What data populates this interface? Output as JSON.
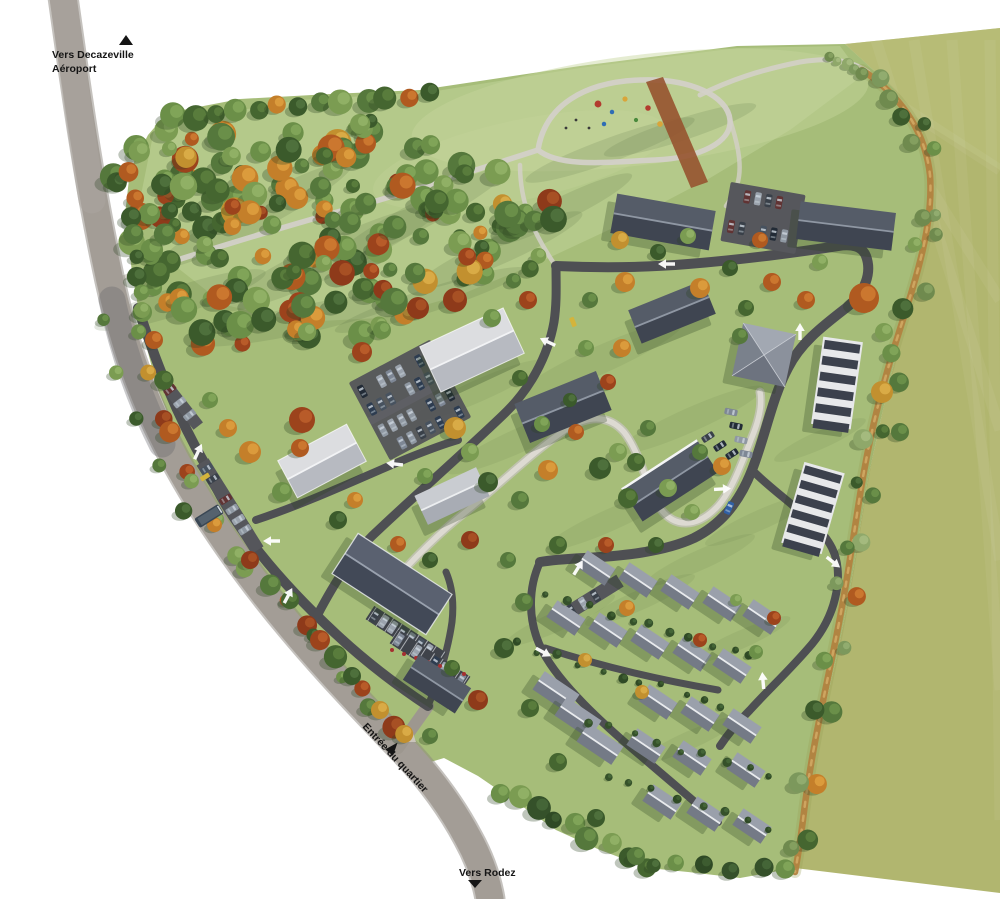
{
  "map": {
    "labels": {
      "north": {
        "line1": "Vers Decazeville",
        "line2": "Aéroport",
        "marker": "triangle-up-icon"
      },
      "south": {
        "text": "Vers Rodez",
        "marker": "triangle-down-icon"
      },
      "entrance": {
        "text": "Entrée du quartier",
        "marker": "triangle-right-icon"
      }
    },
    "icons": [
      "triangle-up-icon",
      "triangle-down-icon",
      "triangle-right-icon",
      "road-direction-arrow-icon"
    ],
    "colors": {
      "background": "#ffffff",
      "field": "#b1b66f",
      "field_light": "#bcc17c",
      "grass": "#a6bd79",
      "park": "#b6ca8c",
      "mow_light": "#c6d59c",
      "road_main": "#a39d96",
      "road_casing": "#8b857d",
      "road_inner": "#4e4f53",
      "path": "#d3d0c8",
      "walkway": "#dddad2",
      "dirt_path": "#b2823f",
      "red_path": "#96532f",
      "roof_dark": "#3f4551",
      "roof_light": "#dcdde0",
      "roof_house": "#9aa0ab",
      "arrow": "#ffffff",
      "label_text": "#151515",
      "tree_green": "#55783c",
      "tree_autumn": "#b05a20"
    }
  }
}
